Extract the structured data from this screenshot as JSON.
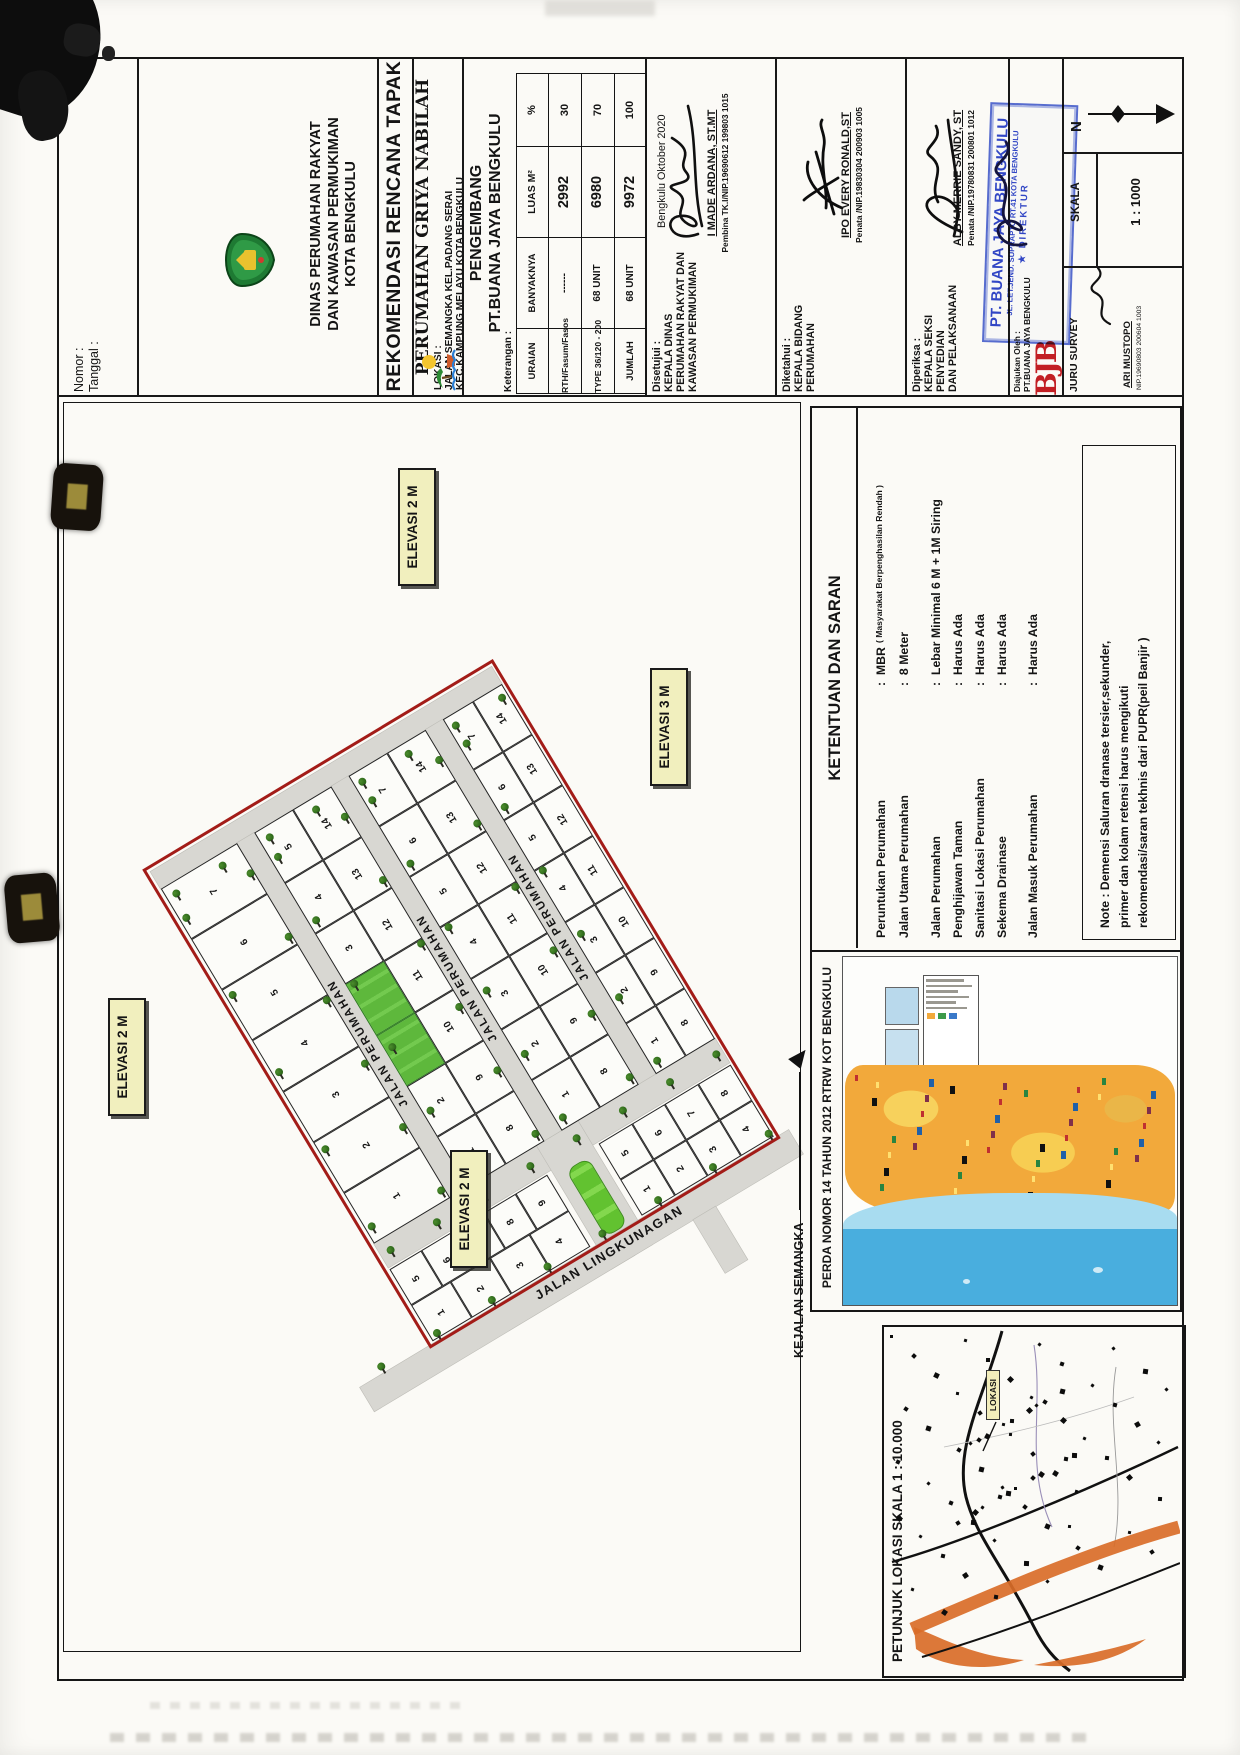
{
  "title_block": {
    "nomor_label": "Nomor      :",
    "tanggal_label": "Tanggal    :",
    "agency": {
      "line1": "DINAS PERUMAHAN RAKYAT",
      "line2": "DAN KAWASAN PERMUKIMAN",
      "line3": "KOTA BENGKULU"
    },
    "doc_title": "REKOMENDASI RENCANA TAPAK",
    "project_title": "PERUMAHAN GRIYA NABILAH",
    "lokasi": {
      "label": "LOKASI :",
      "line1": "JALAN SEMANGKA KEL.PADANG SERAI",
      "line2": "KEC.KAMPUNG MELAYU KOTA BENGKULU"
    },
    "pengembang": {
      "label": "PENGEMBANG",
      "company": "PT.BUANA JAYA BENGKULU"
    },
    "keterangan_label": "Keterangan :",
    "table": {
      "headers": [
        "URAIAN",
        "BANYAKNYA",
        "LUAS M²",
        "%"
      ],
      "rows": [
        [
          "RTH/Fasum/Fasos",
          "------",
          "2992",
          "30"
        ],
        [
          "TYPE 36/120 - 200",
          "68 UNIT",
          "6980",
          "70"
        ],
        [
          "JUMLAH",
          "68 UNIT",
          "9972",
          "100"
        ]
      ]
    },
    "signatures": [
      {
        "section_label": "Disetujui :",
        "role_lines": [
          "KEPALA DINAS",
          "PERUMAHAN RAKYAT DAN",
          "KAWASAN PERMUKIMAN"
        ],
        "place_date": "Bengkulu      Oktober 2020",
        "name": "I MADE ARDANA, ST.MT",
        "nip": "Pembina TK.I/NIP.19690612 199803 1015"
      },
      {
        "section_label": "Diketahui :",
        "role_lines": [
          "KEPALA BIDANG",
          "PERUMAHAN"
        ],
        "name": "IPO EVERY RONALD,ST",
        "nip": "Penata /NIP.19830304 200903 1005"
      },
      {
        "section_label": "Diperiksa :",
        "role_lines": [
          "KEPALA SEKSI",
          "PENYEDIAN",
          "DAN PELAKSANAAN"
        ],
        "name": "ALBY MERRIE SANDY, ST",
        "nip": "Penata /NIP.19780831 200801 1012"
      }
    ],
    "diajukan": {
      "label": "Diajukan Oleh :",
      "company": "PT.BUANA JAYA BENGKULU",
      "logo_text": "BJB"
    },
    "stamp": {
      "company": "PT. BUANA JAYA BENGKULU",
      "address": "JL. LET.JEND. SUPRAPTO RT.41 KOTA BENGKULU",
      "role": "DIREKTUR"
    },
    "compass": {
      "label": "N"
    },
    "skala": {
      "label": "SKALA",
      "value": "1 : 1000"
    },
    "surveyor": {
      "label": "JURU SURVEY",
      "name": "ARI MUSTOPO",
      "nip": "NIP.19690803 200604 1003"
    }
  },
  "site_plan": {
    "elevations": [
      "ELEVASI 2 M",
      "ELEVASI 3 M",
      "ELEVASI 2 M",
      "ELEVASI 2 M"
    ],
    "road_labels": {
      "perumahan": "JALAN PERUMAHAN",
      "lingkungan": "JALAN LINGKUNAGAN",
      "semangka": "KEJALAN SEMANGKA"
    },
    "strip_left": [
      "7",
      "6",
      "5",
      "4",
      "3",
      "2",
      "1"
    ],
    "blocks": [
      {
        "left": [
          "5",
          "4",
          "3",
          "*",
          "*",
          "2",
          "1"
        ],
        "right": [
          "14",
          "13",
          "12",
          "11",
          "10",
          "9",
          "8"
        ]
      },
      {
        "left": [
          "7",
          "6",
          "5",
          "4",
          "3",
          "2",
          "1"
        ],
        "right": [
          "14",
          "13",
          "12",
          "11",
          "10",
          "9",
          "8"
        ]
      },
      {
        "left": [
          "7",
          "6",
          "5",
          "4",
          "3",
          "2",
          "1"
        ],
        "right": [
          "14",
          "13",
          "12",
          "11",
          "10",
          "9",
          "8"
        ]
      }
    ],
    "bottom_left_rows": [
      [
        "5",
        "6",
        "7",
        "8",
        "9"
      ],
      [
        "1",
        "2",
        "3",
        "4"
      ]
    ],
    "bottom_right_rows": [
      [
        "5",
        "6",
        "7",
        "8"
      ],
      [
        "1",
        "2",
        "3",
        "4"
      ]
    ]
  },
  "ketentuan": {
    "title": "KETENTUAN DAN SARAN",
    "items": [
      {
        "label": "Peruntukan Perumahan",
        "value": "MBR",
        "note": "( Masyarakat Berpenghasilan Rendah )"
      },
      {
        "label": "Jalan Utama Perumahan",
        "value": "8 Meter",
        "note": ""
      },
      {
        "label": "Jalan Perumahan",
        "value": "Lebar Minimal 6 M + 1M Siring",
        "note": ""
      },
      {
        "label": "Penghijawan Taman",
        "value": "Harus Ada",
        "note": ""
      },
      {
        "label": "Sanitasi Lokasi Perumahan",
        "value": "Harus Ada",
        "note": ""
      },
      {
        "label": "Sekema Drainase",
        "value": "Harus Ada",
        "note": ""
      },
      {
        "label": "Jalan Masuk Perumahan",
        "value": "Harus Ada",
        "note": ""
      }
    ],
    "note_lines": [
      "Note : Demensi Saluran dranase tersier,sekunder,",
      "primer dan kolam retensi harus  mengikuti",
      "rekomendasi/saran tekhnis dari PUPR(peil Banjir )"
    ]
  },
  "rtrw": {
    "label": "PERDA NOMOR 14 TAHUN 2012 RTRW KOT BENGKULU"
  },
  "petunjuk": {
    "label": "PETUNJUK LOKASI SKALA 1 : 10.000",
    "lokasi_tag": "LOKASI"
  },
  "colors": {
    "boundary_red": "#a31c18",
    "road_gray": "#d8d7d2",
    "park_green": "#66bd40",
    "elevation_bg": "#f1efbe",
    "stamp_blue": "#2742c6",
    "logo_red": "#c21f24",
    "sea_blue": "#49aede",
    "land_orange": "#f2a93b",
    "river_orange": "#d96c28"
  },
  "icons": {
    "tree": "tree-icon",
    "north_arrow": "north-arrow-icon",
    "emblem": "bengkulu-city-emblem",
    "beach": "beach-logo-icon",
    "star": "star-icon",
    "direction_arrow": "direction-arrow-icon"
  }
}
